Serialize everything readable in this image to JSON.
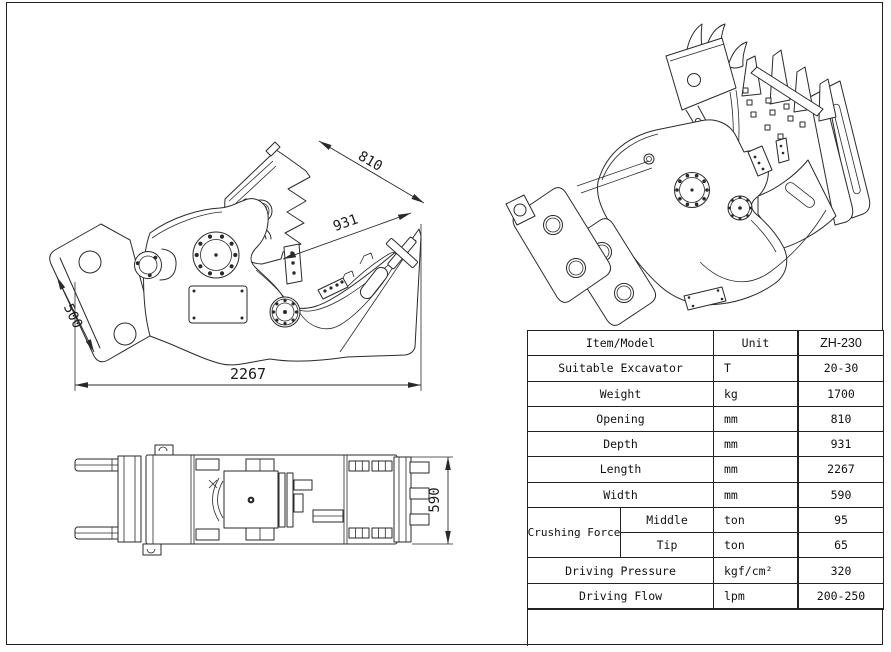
{
  "page": {
    "background": "#ffffff",
    "line_color": "#2a2a2a"
  },
  "dims": {
    "opening": "810",
    "depth": "931",
    "mount": "500",
    "length": "2267",
    "width": "590"
  },
  "table": {
    "header": {
      "item": "Item/Model",
      "unit": "Unit",
      "model": "ZH-230"
    },
    "rows": [
      {
        "item": "Suitable Excavator",
        "unit": "T",
        "value": "20-30"
      },
      {
        "item": "Weight",
        "unit": "kg",
        "value": "1700"
      },
      {
        "item": "Opening",
        "unit": "mm",
        "value": "810"
      },
      {
        "item": "Depth",
        "unit": "mm",
        "value": "931"
      },
      {
        "item": "Length",
        "unit": "mm",
        "value": "2267"
      },
      {
        "item": "Width",
        "unit": "mm",
        "value": "590"
      }
    ],
    "crushing_force": {
      "label": "Crushing Force",
      "middle": {
        "label": "Middle",
        "unit": "ton",
        "value": "95"
      },
      "tip": {
        "label": "Tip",
        "unit": "ton",
        "value": "65"
      }
    },
    "bottom_rows": [
      {
        "item": "Driving Pressure",
        "unit": "kgf/cm²",
        "value": "320"
      },
      {
        "item": "Driving Flow",
        "unit": "lpm",
        "value": "200-250"
      }
    ]
  }
}
